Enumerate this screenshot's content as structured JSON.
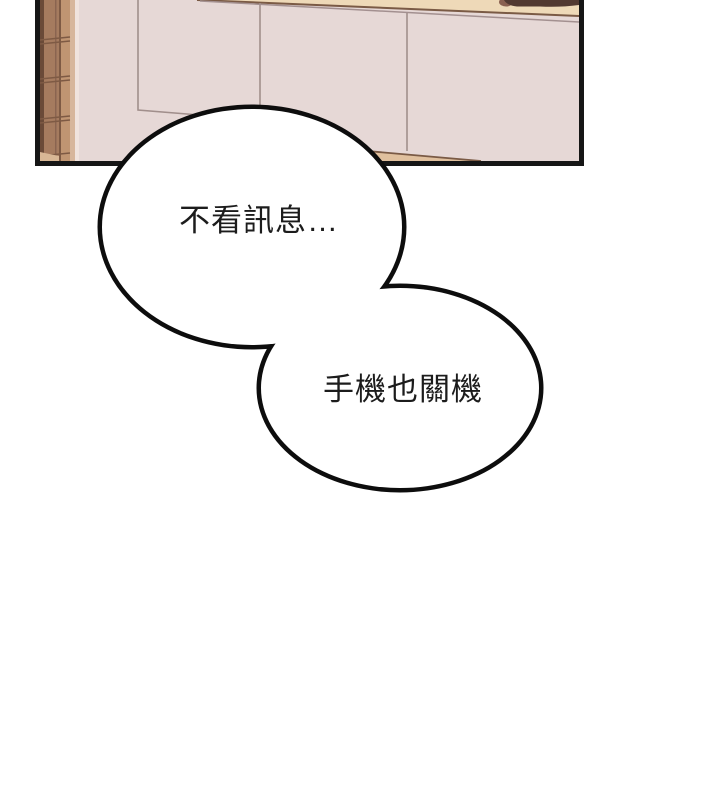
{
  "page": {
    "kind": "comic-panel-page",
    "background_color": "#ffffff"
  },
  "panel": {
    "scene": "kitchen-cabinets",
    "colors": {
      "border": "#161616",
      "cabinet_face": "#e6d8d6",
      "counter_band": "#eed9b8",
      "band_edge_line": "#7a5a45",
      "cabinet_seam_line": "#a18f8c",
      "countertop_wedge": "#e0c09e",
      "wood_pillar_dark": "#6a4a38",
      "wood_pillar_mid": "#a57b5f",
      "wood_pillar_light": "#c09572",
      "wood_pillar_highlight": "#f0e3de",
      "dark_object": "#523931"
    }
  },
  "speech_bubbles": [
    {
      "text": "不看訊息…",
      "fill": "#ffffff",
      "outline": "#0d0d0d"
    },
    {
      "text": "手機也關機",
      "fill": "#ffffff",
      "outline": "#0d0d0d"
    }
  ]
}
